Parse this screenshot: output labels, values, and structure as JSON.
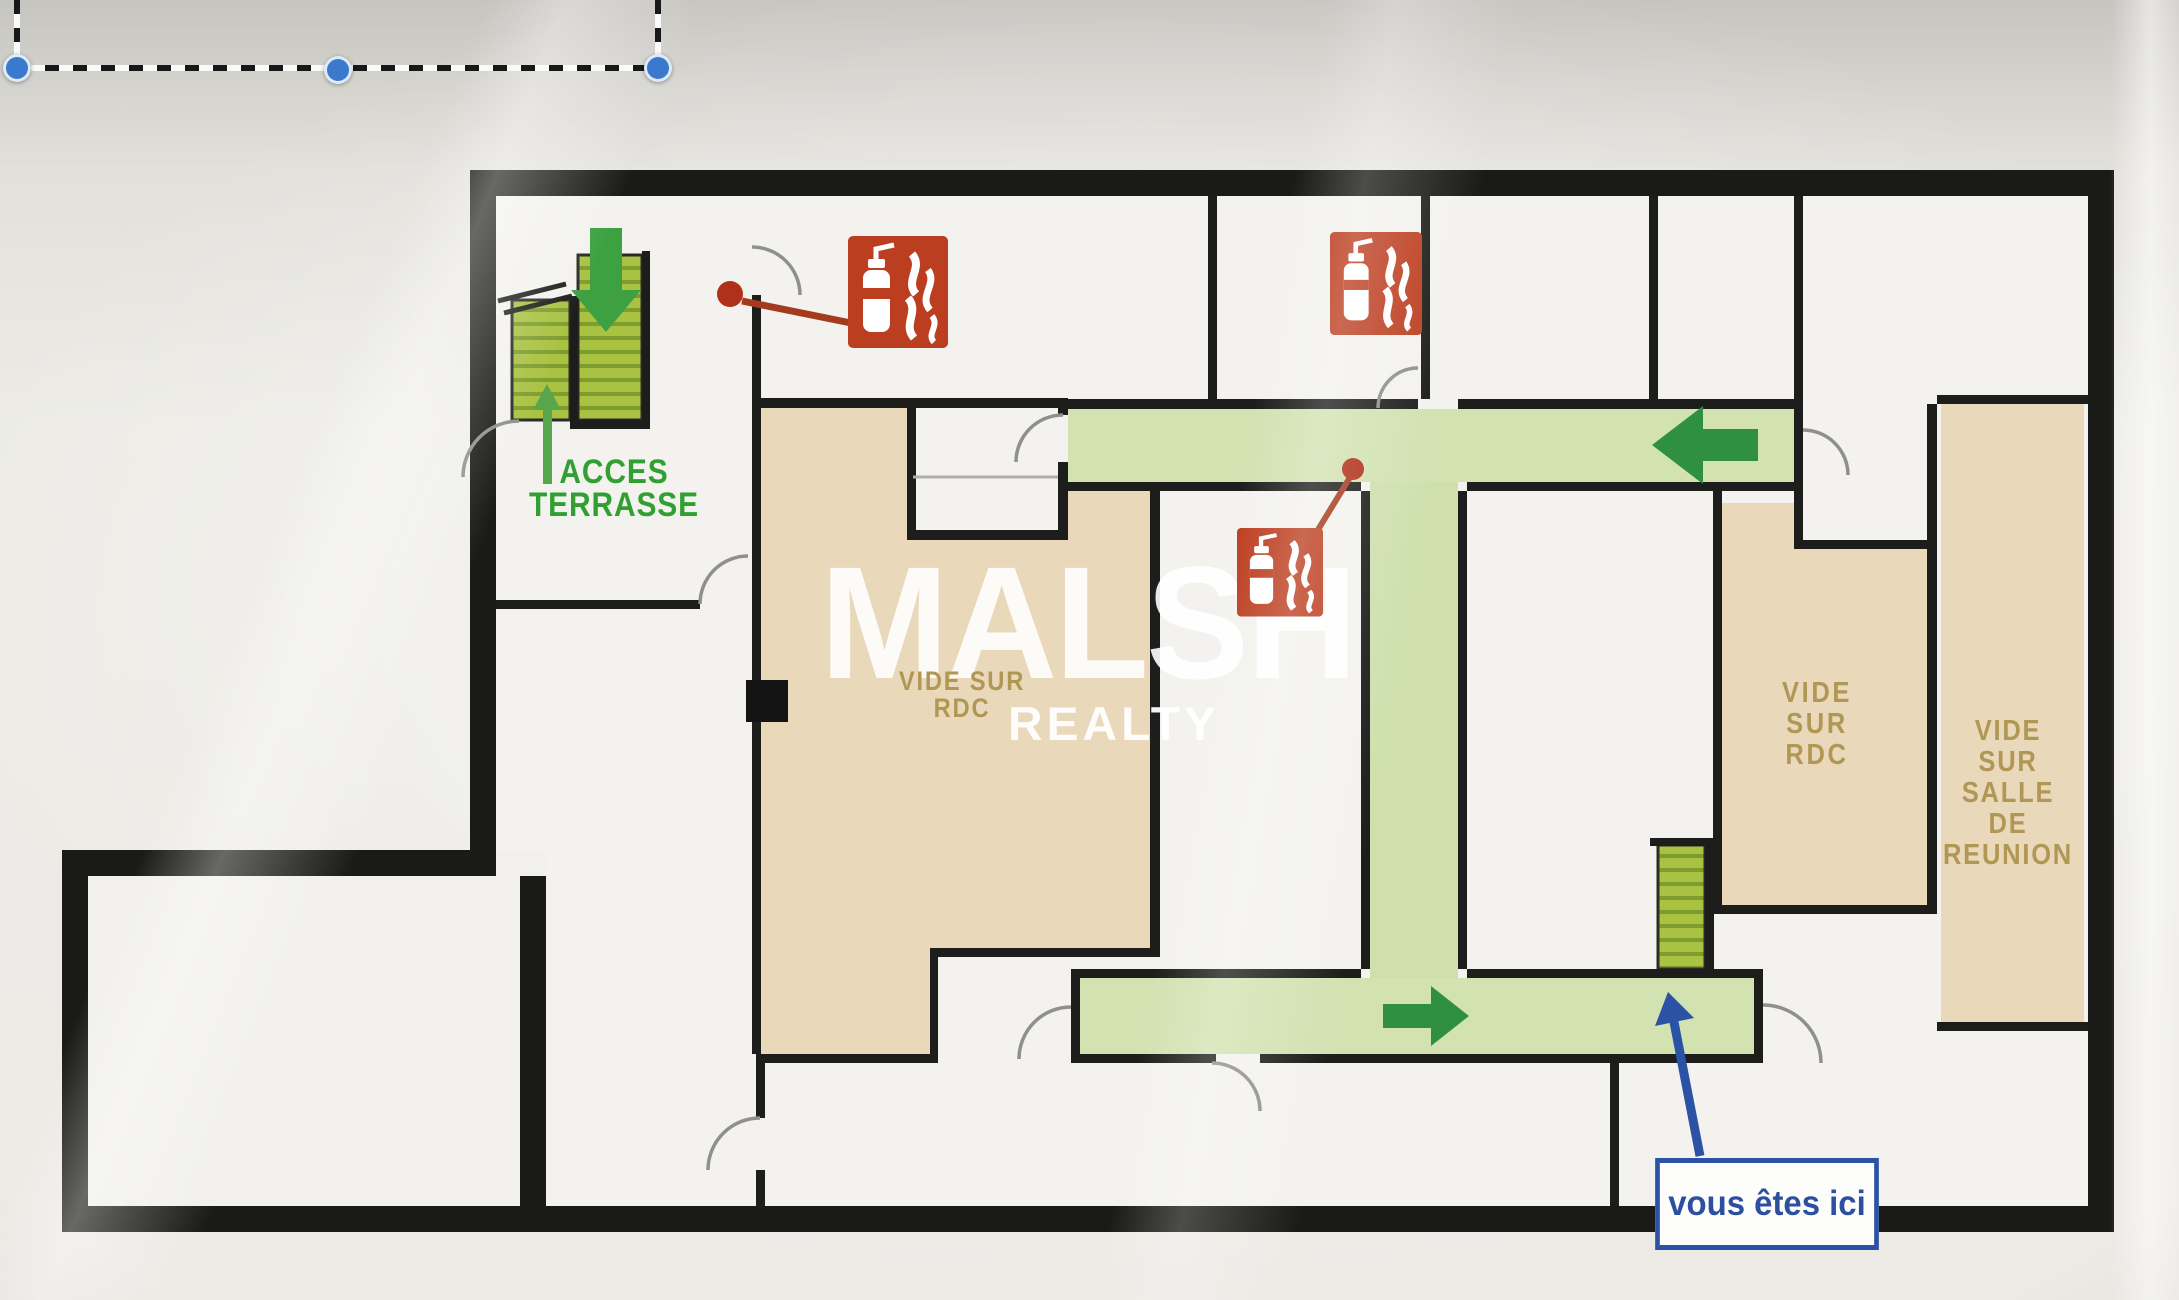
{
  "selection_overlay": {
    "handles": [
      "bottom-left",
      "bottom-middle",
      "bottom-right"
    ]
  },
  "watermark": {
    "brand": "MALSH",
    "tagline": "REALTY"
  },
  "floor_plan": {
    "labels": {
      "acces_terrasse": "ACCES\nTERRASSE",
      "vide_sur_rdc_center": "VIDE SUR\nRDC",
      "vide_sur_rdc_right": "VIDE\nSUR\nRDC",
      "vide_sur_salle_de_reunion": "VIDE\nSUR\nSALLE\nDE\nREUNION",
      "you_are_here": "vous êtes ici"
    },
    "icons": {
      "fire-extinguisher-icon": "red square, white extinguisher bottle + flame pictogram",
      "extinguisher-location-dot": "red dot with leader line to pictogram",
      "evacuation-arrow-icon": "solid dark-green directional arrow on route",
      "stairs-icon": "striped yellow-green stair flight",
      "stairs-direction-arrow-icon": "green arrow over stair flight",
      "you-are-here-arrow-icon": "blue arrow from label box to corridor",
      "door-swing-icon": "thin quarter-circle door arc",
      "pillar-icon": "solid black square column"
    },
    "colors": {
      "walls": "#1a1a18",
      "evacuation_route_green": "#d2e2b0",
      "route_arrow_green": "#2e9140",
      "stairs_green": "#a9c23e",
      "void_room_beige": "#ead8ba",
      "room_label_khaki": "#b29752",
      "safety_red": "#bf3d1e",
      "you_are_here_blue": "#2b52a8",
      "label_green": "#2fa02f"
    }
  }
}
